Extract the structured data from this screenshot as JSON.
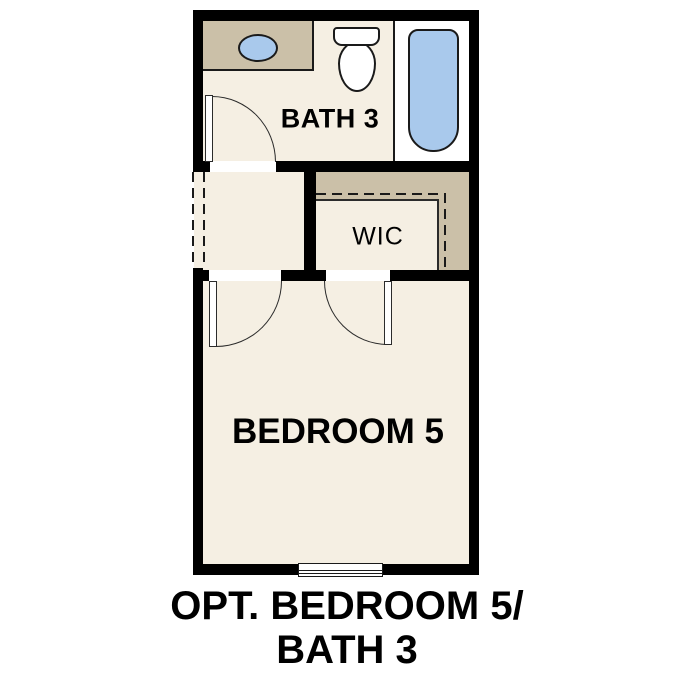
{
  "caption": {
    "line1": "OPT. BEDROOM 5/",
    "line2": "BATH 3"
  },
  "rooms": {
    "bath": {
      "label": "BATH 3"
    },
    "wic": {
      "label": "WIC"
    },
    "bedroom": {
      "label": "BEDROOM 5"
    }
  },
  "fixtures": {
    "sink": "oval-vanity-sink",
    "toilet": "toilet",
    "tub": "bathtub-shower",
    "window": "double-pane-window",
    "doors": [
      "bath-door-swing",
      "bedroom-door-swing",
      "wic-door-swing"
    ],
    "closet_rod": "dashed-closet-rod-and-shelf",
    "optional_opening": "dashed-optional-wall-opening"
  },
  "colors": {
    "wall": "#000000",
    "floor": "#f5efe3",
    "shelf": "#cbc0a8",
    "fixture": "#a9c9ec",
    "line": "#1a1a1a",
    "text": "#000000"
  }
}
